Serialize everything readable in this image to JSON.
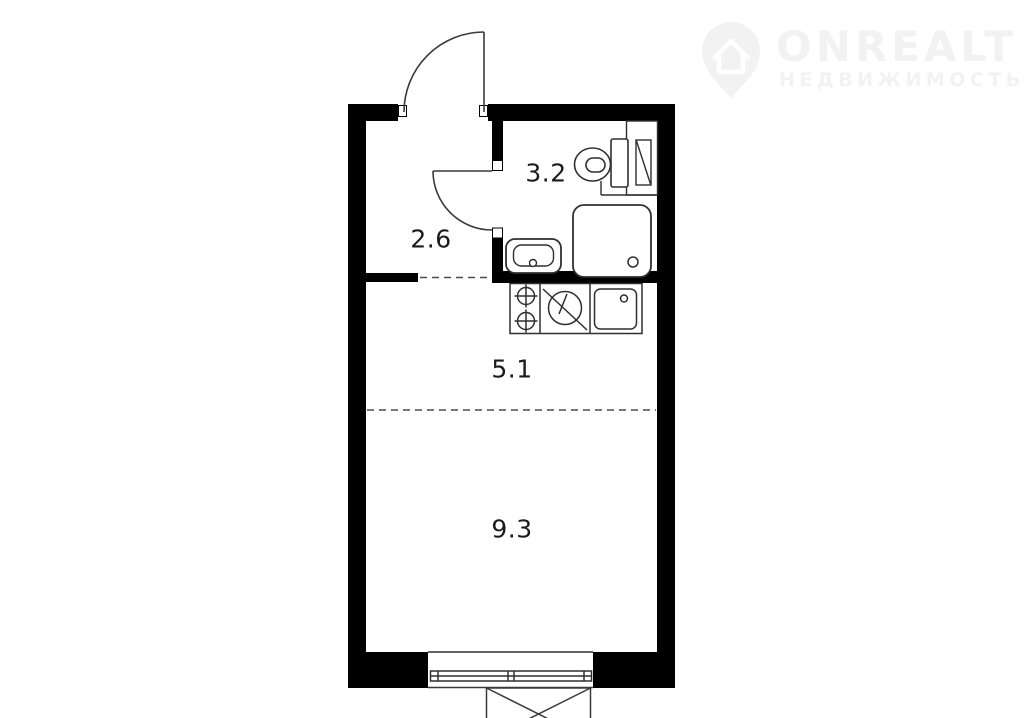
{
  "watermark": {
    "brand": "ONREALT",
    "subtitle": "НЕДВИЖИМОСТЬ",
    "icon": "location-pin-house-icon",
    "color": "#f2f2f2"
  },
  "floorplan": {
    "type": "studio-apartment-floor-plan",
    "colors": {
      "background": "#ffffff",
      "wall": "#000000",
      "fixture_line": "#2f2f2f",
      "dashed_line": "#4d4d4d",
      "label_text": "#1b1b1b"
    },
    "rooms": [
      {
        "name": "hallway",
        "area_label": "2.6"
      },
      {
        "name": "bathroom",
        "area_label": "3.2"
      },
      {
        "name": "kitchen",
        "area_label": "5.1"
      },
      {
        "name": "living-room",
        "area_label": "9.3"
      }
    ],
    "fixtures": [
      "entry-door",
      "bathroom-door",
      "toilet",
      "vent-shaft",
      "shower-tray",
      "washbasin",
      "two-burner-stove",
      "kitchen-appliance",
      "kitchen-sink",
      "window",
      "balcony"
    ]
  }
}
